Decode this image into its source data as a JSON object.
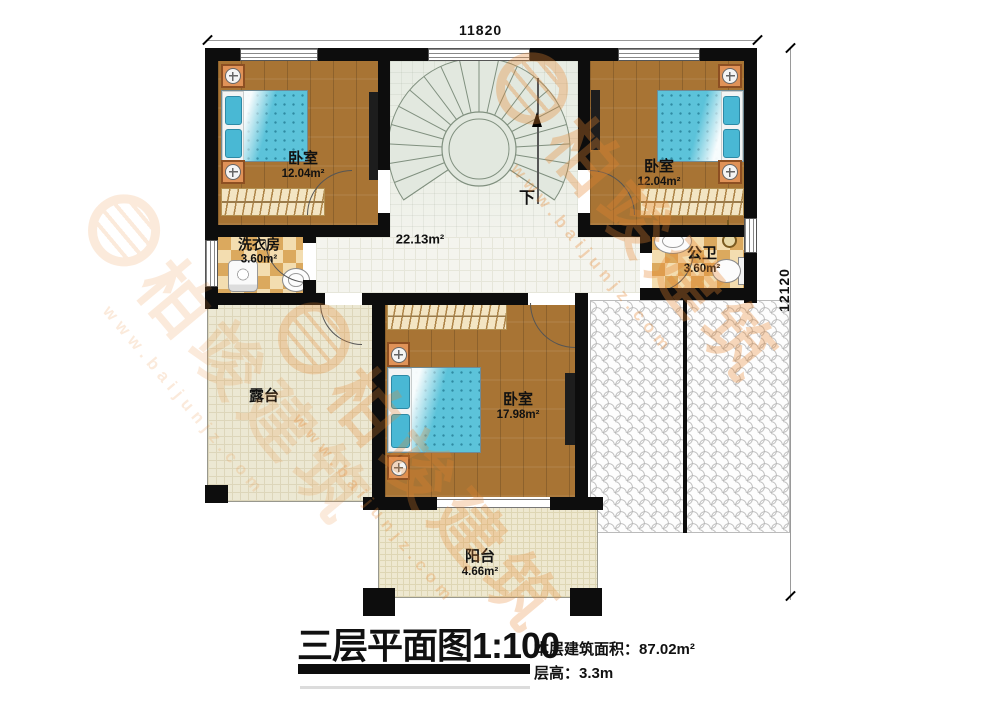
{
  "plan": {
    "dimensions": {
      "width_mm": "11820",
      "height_mm": "12120"
    },
    "rooms": {
      "bedroom1": {
        "name": "卧室",
        "area": "12.04m²"
      },
      "bedroom2": {
        "name": "卧室",
        "area": "12.04m²"
      },
      "bedroom3": {
        "name": "卧室",
        "area": "17.98m²"
      },
      "laundry": {
        "name": "洗衣房",
        "area": "3.60m²"
      },
      "bathroom": {
        "name": "公卫",
        "area": "3.60m²"
      },
      "hallway": {
        "area": "22.13m²"
      },
      "terrace": {
        "name": "露台"
      },
      "balcony": {
        "name": "阳台",
        "area": "4.66m²"
      }
    },
    "stairs": {
      "direction_label": "下"
    }
  },
  "title_block": {
    "title": "三层平面图",
    "scale": "1:100",
    "floor_area_label": "本层建筑面积：",
    "floor_area_value": "87.02m²",
    "floor_height_label": "层高：",
    "floor_height_value": "3.3m"
  },
  "watermark": {
    "brand": "柏竣建筑",
    "url": "www.baijunjz.com"
  },
  "colors": {
    "wall": "#0d0d0d",
    "wood_floor": "#a87434",
    "bed_blue": "#5cc3da",
    "tile_light": "#f3ddb0",
    "tile_dark": "#dba95e",
    "stair_green": "#e2e8df",
    "terrace_floor": "#ece8d3",
    "watermark_orange": "#e8862f"
  }
}
